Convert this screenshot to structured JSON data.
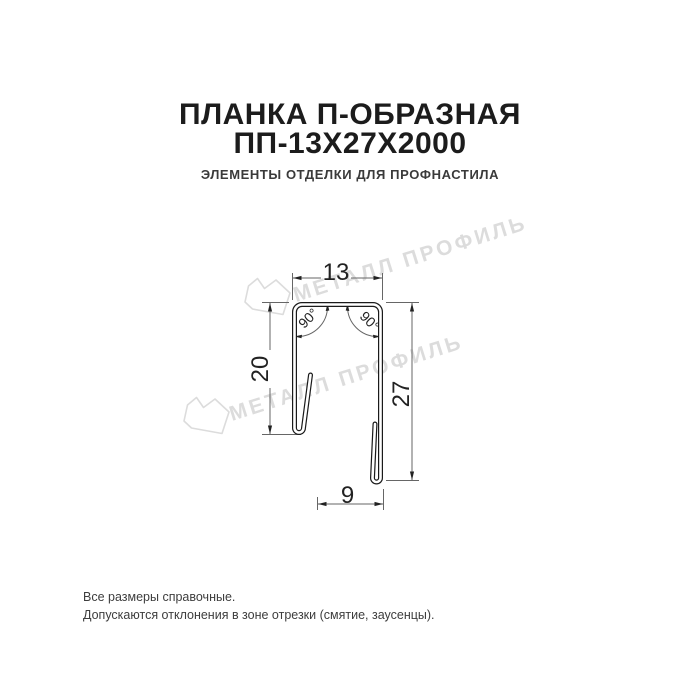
{
  "header": {
    "title_line1": "ПЛАНКА П-ОБРАЗНАЯ",
    "title_line2": "ПП-13Х27Х2000",
    "subtitle": "ЭЛЕМЕНТЫ ОТДЕЛКИ ДЛЯ ПРОФНАСТИЛА"
  },
  "drawing": {
    "dimensions": {
      "top_width": "13",
      "left_height": "20",
      "right_height": "27",
      "bottom_width": "9",
      "angle_left": "90°",
      "angle_right": "90°"
    },
    "line_color": "#1a1a1a",
    "dim_line_color": "#666666"
  },
  "watermark": {
    "text": "МЕТАЛЛ ПРОФИЛЬ",
    "color": "#dcdcdc",
    "logo": "metall-profil-logo"
  },
  "footer": {
    "line1": "Все размеры справочные.",
    "line2": "Допускаются отклонения в зоне отрезки (смятие, заусенцы)."
  }
}
